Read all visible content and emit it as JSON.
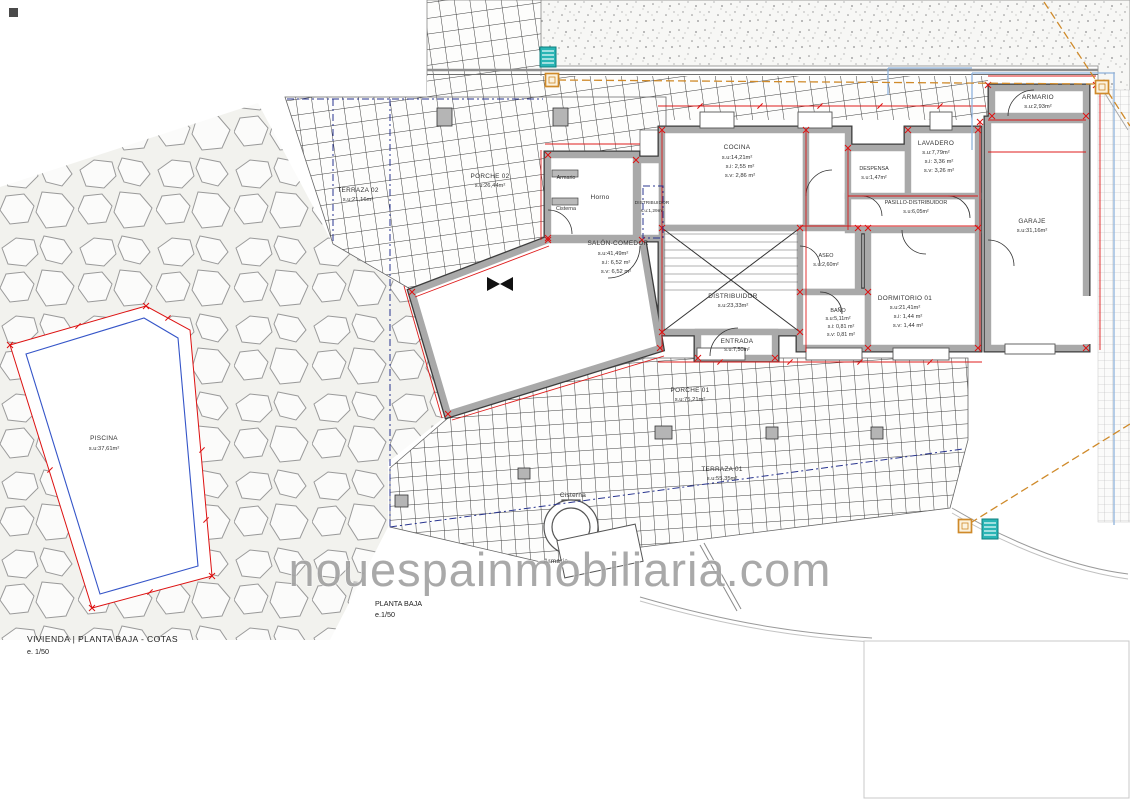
{
  "sheet": {
    "title": "VIVIENDA | PLANTA BAJA - COTAS",
    "scale": "e. 1/50"
  },
  "plan_caption": {
    "label": "PLANTA BAJA",
    "scale": "e.1/50"
  },
  "watermark": "nouespainmobiliaria.com",
  "colors": {
    "dimension_red": "#dd1111",
    "wall_gray": "#a9a9a9",
    "boundary_orange": "#cf8a2a",
    "parcel_blue": "#8fb3dc",
    "axis_navy": "#28348f",
    "water_teal": "#2ab5b5"
  },
  "rooms": {
    "terraza02": {
      "name": "TERRAZA 02",
      "su": "s.u:21,16m²"
    },
    "porche02": {
      "name": "PORCHE 02",
      "su": "s.u:26,44m²"
    },
    "salon": {
      "name": "SALÓN-COMEDOR",
      "su": "s.u:41,49m²",
      "si": "s.i:  6,52 m²",
      "sv": "s.v:  6,52 m²"
    },
    "horno": {
      "name": "Horno"
    },
    "distribuidor_peq": {
      "name": "DISTRIBUIDOR",
      "su": "s.u:1,29m²"
    },
    "cocina": {
      "name": "COCINA",
      "su": "s.u:14,21m²",
      "si": "s.i:  2,55 m²",
      "sv": "s.v:  2,86 m²"
    },
    "despensa": {
      "name": "DESPENSA",
      "su": "s.u:1,47m²"
    },
    "lavadero": {
      "name": "LAVADERO",
      "su": "s.u:7,79m²",
      "si": "s.i:  3,36 m²",
      "sv": "s.v:  3,26 m²"
    },
    "pasillo": {
      "name": "PASILLO-DISTRIBUIDOR",
      "su": "s.u:6,05m²"
    },
    "armario_garaje": {
      "name": "ARMARIO",
      "su": "s.u:2,93m²"
    },
    "garaje": {
      "name": "GARAJE",
      "su": "s.u:31,16m²"
    },
    "distribuidor": {
      "name": "DISTRIBUIDOR",
      "su": "s.u:23,33m²"
    },
    "aseo": {
      "name": "ASEO",
      "su": "s.u:2,60m²"
    },
    "bano": {
      "name": "BAÑO",
      "su": "s.u:5,11m²",
      "si": "s.i:  0,81 m²",
      "sv": "s.v:  0,81 m²"
    },
    "dormitorio01": {
      "name": "DORMITORIO 01",
      "su": "s.u:21,41m²",
      "si": "s.i:  1,44 m²",
      "sv": "s.v:  1,44 m²"
    },
    "entrada": {
      "name": "ENTRADA",
      "su": "s.u:7,50m²"
    },
    "porche01": {
      "name": "PORCHE 01",
      "su": "s.u:75,21m²"
    },
    "terraza01": {
      "name": "TERRAZA 01",
      "su": "s.u:55,35m²"
    },
    "piscina": {
      "name": "PISCINA",
      "su": "s.u:37,61m²"
    }
  },
  "fixtures": {
    "armario_wall": "Armario",
    "cisterna_wall": "Cisterna",
    "cisterna_ext": "Cisterna",
    "armario_ext": "Armario"
  }
}
